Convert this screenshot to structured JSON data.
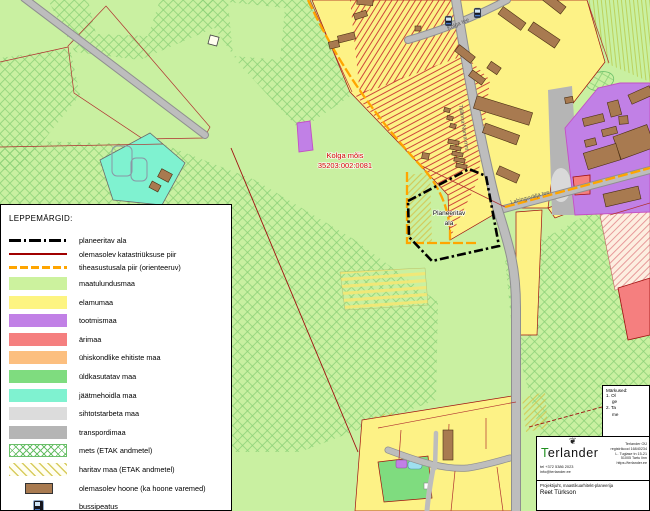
{
  "map": {
    "labels": {
      "estate_name": "Kolga mõis",
      "estate_cadastre": "35203:002:0081",
      "planned_area_line1": "Planeeritav",
      "planned_area_line2": "ala",
      "road_main": "Tallinna-Narva mnt",
      "road_top": "Kolga tee",
      "road_east": "Lahinguvälja tee"
    },
    "colors": {
      "base_green": "#c9f0a1",
      "elamumaa": "#fdf286",
      "tootmismaa": "#c180e6",
      "arimaa": "#f57f7f",
      "yhiskondlike": "#fcbf7f",
      "yldkasutatav": "#7fdc7f",
      "jaatmehoidla": "#7ff2d0",
      "sihtotstarbeta": "#d9d9d9",
      "transpordimaa": "#b5b5b5",
      "hoone_brown": "#a87a50",
      "road_gray": "#bdbdbd",
      "cadastre_red": "#a01010",
      "tiheasustus_orange": "#ffa500"
    }
  },
  "legend": {
    "title": "LEPPEMÄRGID:",
    "items": [
      {
        "type": "dashdot",
        "color": "#000000",
        "label": "planeeritav ala"
      },
      {
        "type": "line",
        "color": "#a00000",
        "label": "olemasolev katastriüksuse piir"
      },
      {
        "type": "dash-orange",
        "color": "#ffa500",
        "label": "tiheasustusala piir (orienteeruv)"
      },
      {
        "type": "swatch",
        "color": "#ccf29e",
        "label": "maatulundusmaa"
      },
      {
        "type": "swatch",
        "color": "#fdf481",
        "label": "elamumaa"
      },
      {
        "type": "swatch",
        "color": "#c180e6",
        "label": "tootmismaa"
      },
      {
        "type": "swatch",
        "color": "#f57f7f",
        "label": "ärimaa"
      },
      {
        "type": "swatch",
        "color": "#fcbf7f",
        "label": "ühiskondlike ehitiste maa"
      },
      {
        "type": "swatch",
        "color": "#7fdc7f",
        "label": "üldkasutatav maa"
      },
      {
        "type": "swatch",
        "color": "#7ff2d0",
        "label": "jäätmehoidla maa"
      },
      {
        "type": "swatch",
        "color": "#dcdcdc",
        "label": "sihtotstarbeta maa"
      },
      {
        "type": "swatch",
        "color": "#b5b5b5",
        "label": "transpordimaa"
      },
      {
        "type": "hatch-cross",
        "color": "#6abf69",
        "label": "mets (ETAK andmetel)"
      },
      {
        "type": "hatch-diag",
        "color": "#d8cc5e",
        "label": "haritav maa (ETAK andmetel)"
      },
      {
        "type": "building",
        "color": "#a87a50",
        "label": "olemasolev hoone (ka hoone varemed)"
      },
      {
        "type": "busstop",
        "color": "#16161d",
        "label": "bussipeatus"
      }
    ]
  },
  "notes": {
    "title": "Märkused:",
    "lines": [
      "1. Ol",
      "ge",
      "2. Ta",
      "me"
    ]
  },
  "title_block": {
    "company_initial": "T",
    "company_rest": "erlander",
    "logo_glyph": "❦",
    "details": [
      "Terlander OÜ",
      "registrikood 16840234",
      "L. Tuglase tn 15-21",
      "51005 Tartu linn",
      "https://terlander.ee"
    ],
    "phone": "tel +372 5386 2023",
    "email": "info@terlander.ee",
    "role": "Projektijuht, maastikuarhitekt-planeerija",
    "author": "Reet Türkson"
  }
}
